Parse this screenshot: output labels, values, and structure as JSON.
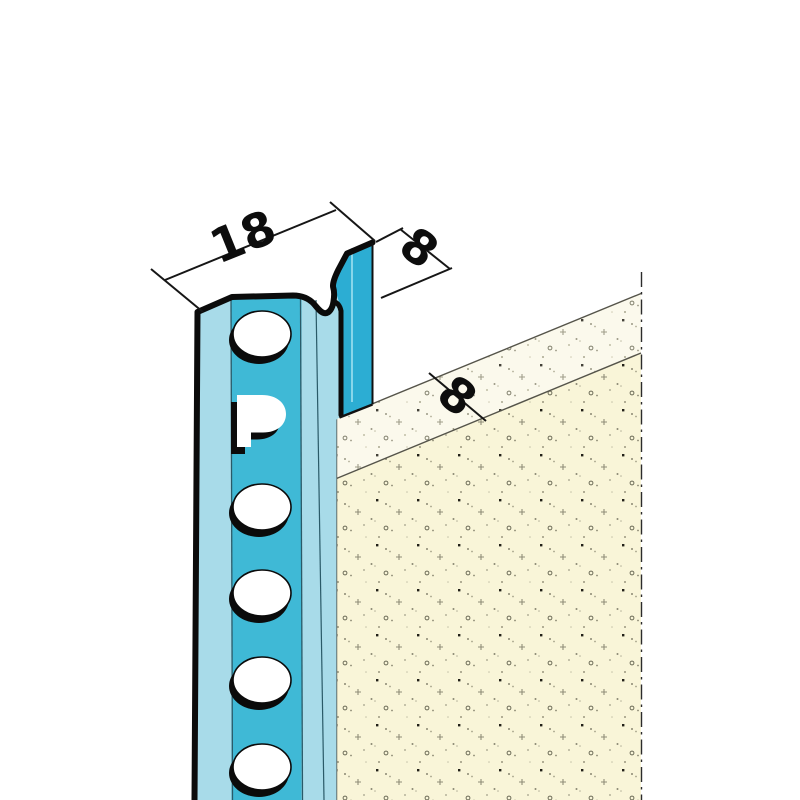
{
  "drawing": {
    "dimension_labels": {
      "profile_width": "18",
      "upstand_height": "8",
      "plaster_thickness": "8"
    },
    "brand_letter": "P",
    "colors": {
      "background": "#ffffff",
      "profile_light": "#a8dbe9",
      "profile_mid": "#3fb9d6",
      "profile_upstand": "#2cadd3",
      "profile_outline": "#0b0b0b",
      "separator_line": "#2a5a68",
      "hole_fill": "#ffffff",
      "plaster_front": "#f9f5d8",
      "plaster_top": "#fbf9ec",
      "edge_line": "#55544a",
      "cut_line": "#2c2c2c",
      "dimension_line": "#161616",
      "dimension_text": "#0d0d0d"
    }
  }
}
